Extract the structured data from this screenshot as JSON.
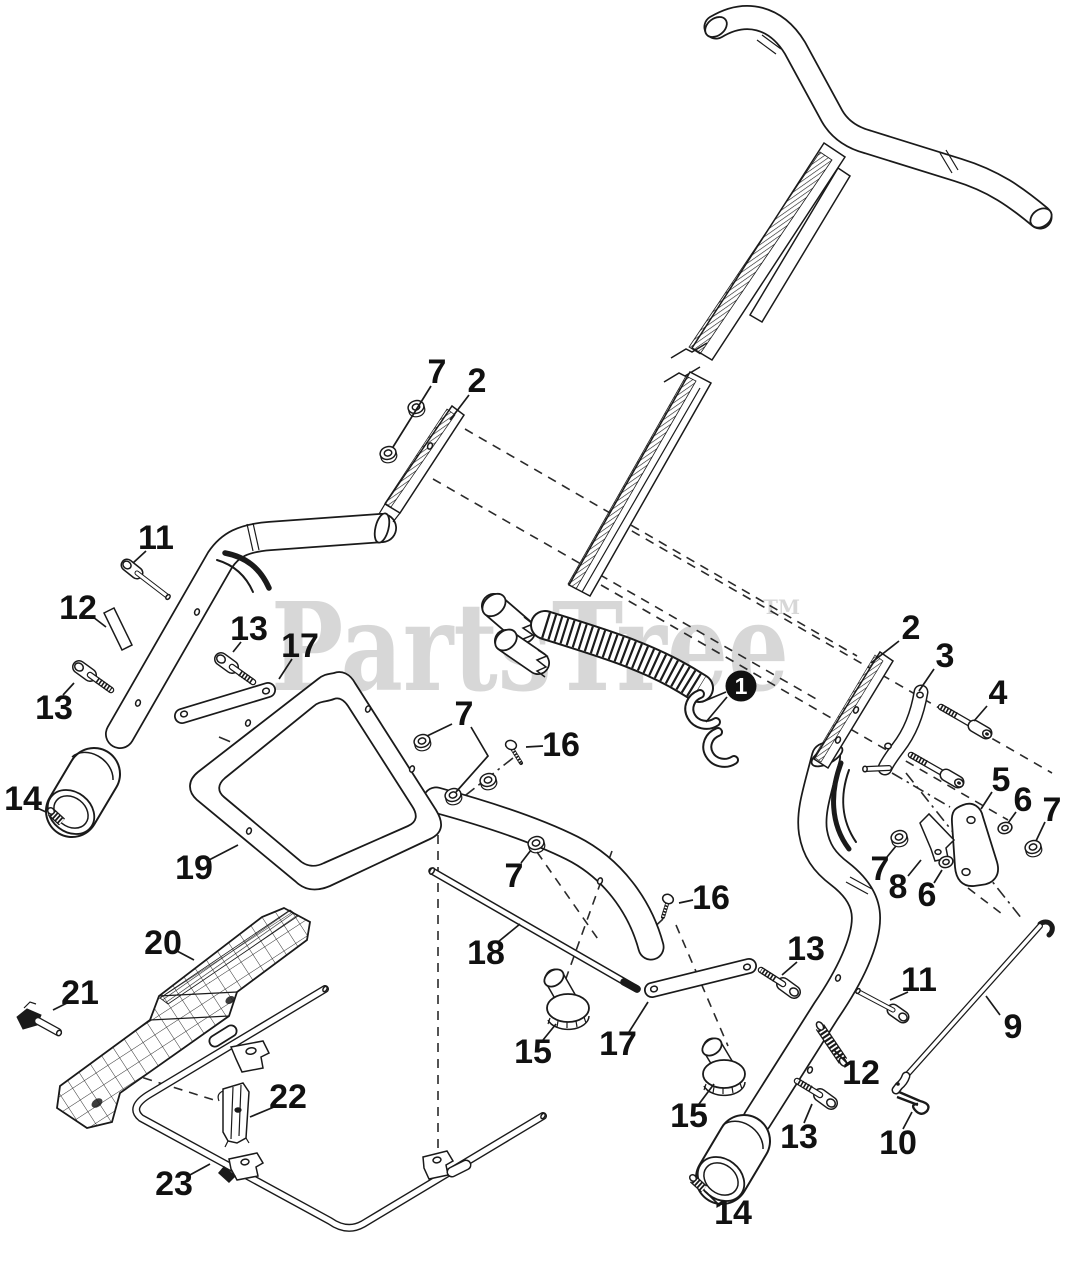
{
  "page": {
    "width": 1067,
    "height": 1280,
    "background": "#ffffff"
  },
  "watermark": {
    "text": "PartsTree",
    "trademark": "TM",
    "color": "#d7d7d7"
  },
  "diagram": {
    "description": "Exploded parts diagram of a walk-behind mower handle assembly",
    "line_color": "#1a1a1a",
    "callouts": [
      {
        "label": "7",
        "x": 437,
        "y": 372,
        "leaders": [
          [
            [
              431,
              386
            ],
            [
              393,
              447
            ]
          ]
        ]
      },
      {
        "label": "2",
        "x": 477,
        "y": 381,
        "leaders": [
          [
            [
              469,
              395
            ],
            [
              450,
              420
            ]
          ]
        ]
      },
      {
        "label": "11",
        "x": 156,
        "y": 538,
        "leaders": [
          [
            [
              146,
              551
            ],
            [
              133,
              563
            ]
          ]
        ]
      },
      {
        "label": "12",
        "x": 78,
        "y": 608,
        "leaders": [
          [
            [
              93,
              617
            ],
            [
              106,
              627
            ]
          ]
        ]
      },
      {
        "label": "13",
        "x": 249,
        "y": 629,
        "leaders": [
          [
            [
              241,
              642
            ],
            [
              233,
              652
            ]
          ]
        ]
      },
      {
        "label": "17",
        "x": 300,
        "y": 646,
        "leaders": [
          [
            [
              292,
              659
            ],
            [
              279,
              679
            ]
          ]
        ]
      },
      {
        "label": "13",
        "x": 54,
        "y": 708,
        "leaders": [
          [
            [
              63,
              695
            ],
            [
              74,
              683
            ]
          ]
        ]
      },
      {
        "label": "14",
        "x": 23,
        "y": 799,
        "leaders": [
          [
            [
              35,
              807
            ],
            [
              46,
              812
            ]
          ]
        ]
      },
      {
        "label": "19",
        "x": 194,
        "y": 868,
        "leaders": [
          [
            [
              209,
              860
            ],
            [
              238,
              845
            ]
          ]
        ]
      },
      {
        "label": "1",
        "x": 741,
        "y": 686,
        "filled": true,
        "leaders": [
          [
            [
              726,
              692
            ],
            [
              702,
              702
            ]
          ],
          [
            [
              727,
              697
            ],
            [
              706,
              722
            ]
          ]
        ]
      },
      {
        "label": "7",
        "x": 464,
        "y": 714,
        "leaders": [
          [
            [
              452,
              724
            ],
            [
              427,
              736
            ]
          ],
          [
            [
              471,
              727
            ],
            [
              488,
              756
            ],
            [
              456,
              792
            ]
          ]
        ]
      },
      {
        "label": "16",
        "x": 561,
        "y": 745,
        "leaders": [
          [
            [
              543,
              746
            ],
            [
              526,
              747
            ]
          ]
        ]
      },
      {
        "label": "7",
        "x": 514,
        "y": 876,
        "leaders": [
          [
            [
              521,
              863
            ],
            [
              531,
              850
            ]
          ]
        ]
      },
      {
        "label": "16",
        "x": 711,
        "y": 898,
        "leaders": [
          [
            [
              693,
              900
            ],
            [
              679,
              903
            ]
          ]
        ]
      },
      {
        "label": "18",
        "x": 486,
        "y": 953,
        "leaders": [
          [
            [
              498,
              942
            ],
            [
              520,
              924
            ]
          ]
        ]
      },
      {
        "label": "15",
        "x": 533,
        "y": 1052,
        "leaders": [
          [
            [
              543,
              1040
            ],
            [
              556,
              1024
            ]
          ]
        ]
      },
      {
        "label": "17",
        "x": 618,
        "y": 1044,
        "leaders": [
          [
            [
              629,
              1032
            ],
            [
              648,
              1002
            ]
          ]
        ]
      },
      {
        "label": "15",
        "x": 689,
        "y": 1116,
        "leaders": [
          [
            [
              699,
              1104
            ],
            [
              714,
              1084
            ]
          ]
        ]
      },
      {
        "label": "2",
        "x": 911,
        "y": 628,
        "leaders": [
          [
            [
              899,
              641
            ],
            [
              871,
              663
            ]
          ]
        ]
      },
      {
        "label": "3",
        "x": 945,
        "y": 656,
        "leaders": [
          [
            [
              934,
              669
            ],
            [
              919,
              691
            ]
          ]
        ]
      },
      {
        "label": "4",
        "x": 998,
        "y": 693,
        "leaders": [
          [
            [
              987,
              706
            ],
            [
              974,
              721
            ]
          ]
        ]
      },
      {
        "label": "5",
        "x": 1001,
        "y": 780,
        "leaders": [
          [
            [
              992,
              792
            ],
            [
              981,
              809
            ]
          ]
        ]
      },
      {
        "label": "6",
        "x": 1023,
        "y": 800,
        "leaders": [
          [
            [
              1016,
              812
            ],
            [
              1008,
              823
            ]
          ]
        ]
      },
      {
        "label": "7",
        "x": 1052,
        "y": 810,
        "leaders": [
          [
            [
              1045,
              822
            ],
            [
              1036,
              841
            ]
          ]
        ]
      },
      {
        "label": "7",
        "x": 880,
        "y": 869,
        "leaders": [
          [
            [
              887,
              857
            ],
            [
              896,
              846
            ]
          ]
        ]
      },
      {
        "label": "8",
        "x": 898,
        "y": 887,
        "leaders": [
          [
            [
              908,
              876
            ],
            [
              921,
              860
            ]
          ]
        ]
      },
      {
        "label": "6",
        "x": 927,
        "y": 895,
        "leaders": [
          [
            [
              934,
              883
            ],
            [
              942,
              870
            ]
          ]
        ]
      },
      {
        "label": "13",
        "x": 806,
        "y": 949,
        "leaders": [
          [
            [
              797,
              962
            ],
            [
              782,
              975
            ]
          ]
        ]
      },
      {
        "label": "11",
        "x": 919,
        "y": 980,
        "leaders": [
          [
            [
              908,
              992
            ],
            [
              890,
              1000
            ]
          ]
        ]
      },
      {
        "label": "9",
        "x": 1013,
        "y": 1027,
        "leaders": [
          [
            [
              1000,
              1015
            ],
            [
              986,
              996
            ]
          ]
        ]
      },
      {
        "label": "12",
        "x": 861,
        "y": 1073,
        "leaders": [
          [
            [
              848,
              1064
            ],
            [
              834,
              1050
            ]
          ]
        ]
      },
      {
        "label": "13",
        "x": 799,
        "y": 1137,
        "leaders": [
          [
            [
              804,
              1123
            ],
            [
              812,
              1104
            ]
          ]
        ]
      },
      {
        "label": "10",
        "x": 898,
        "y": 1143,
        "leaders": [
          [
            [
              903,
              1129
            ],
            [
              912,
              1112
            ]
          ]
        ]
      },
      {
        "label": "14",
        "x": 733,
        "y": 1213,
        "leaders": [
          [
            [
              720,
              1206
            ],
            [
              706,
              1192
            ]
          ]
        ]
      },
      {
        "label": "20",
        "x": 163,
        "y": 943,
        "leaders": [
          [
            [
              177,
              951
            ],
            [
              194,
              960
            ]
          ]
        ]
      },
      {
        "label": "21",
        "x": 80,
        "y": 993,
        "leaders": [
          [
            [
              67,
              1003
            ],
            [
              53,
              1010
            ]
          ]
        ]
      },
      {
        "label": "22",
        "x": 288,
        "y": 1097,
        "leaders": [
          [
            [
              274,
              1107
            ],
            [
              250,
              1117
            ]
          ]
        ]
      },
      {
        "label": "23",
        "x": 174,
        "y": 1184,
        "leaders": [
          [
            [
              188,
              1176
            ],
            [
              210,
              1164
            ]
          ]
        ]
      }
    ]
  }
}
